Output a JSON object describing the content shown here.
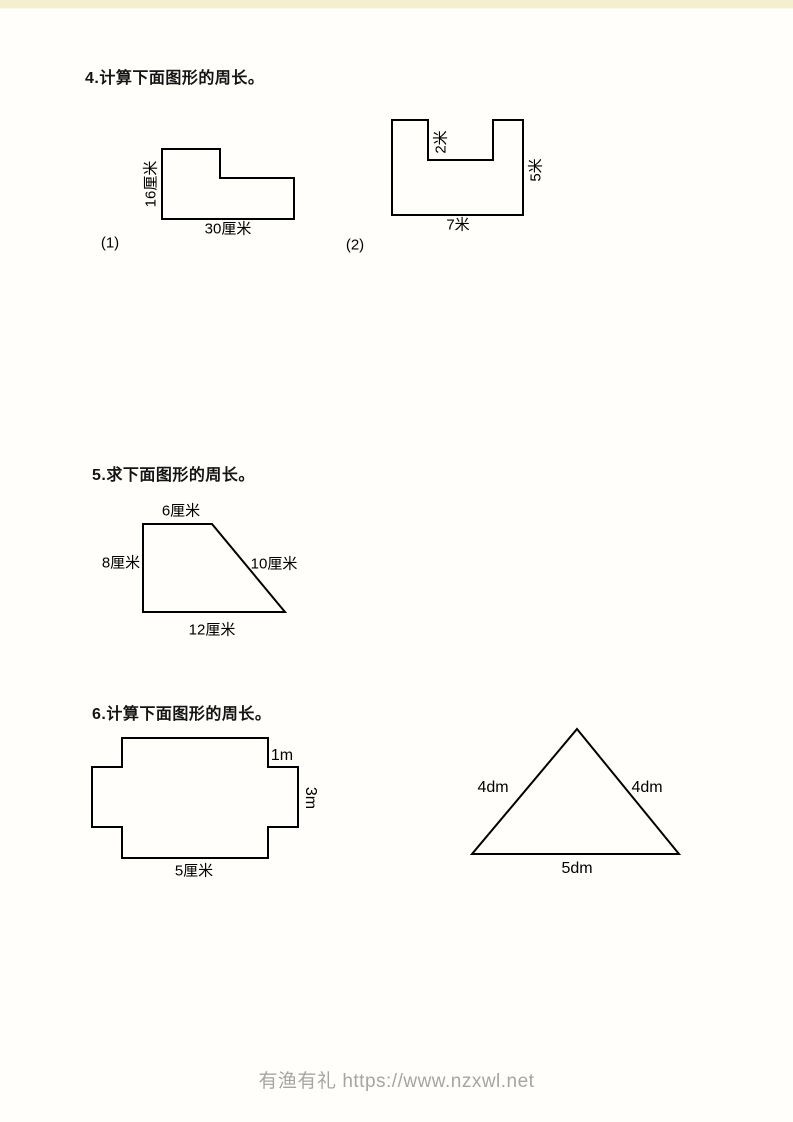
{
  "page": {
    "top_strip_color": "#f3efcf",
    "background": "#fffefa"
  },
  "problems": {
    "p4": {
      "title": "4.计算下面图形的周长。",
      "fig1": {
        "index": "(1)",
        "left": "16厘米",
        "bottom": "30厘米"
      },
      "fig2": {
        "index": "(2)",
        "notch": "2米",
        "right": "5米",
        "bottom": "7米"
      }
    },
    "p5": {
      "title": "5.求下面图形的周长。",
      "fig": {
        "top": "6厘米",
        "left": "8厘米",
        "slant": "10厘米",
        "bottom": "12厘米"
      }
    },
    "p6": {
      "title": "6.计算下面图形的周长。",
      "cross": {
        "step": "1m",
        "right": "3m",
        "bottom": "5厘米"
      },
      "triangle": {
        "left": "4dm",
        "right": "4dm",
        "bottom": "5dm"
      }
    }
  },
  "footer": {
    "text": "有渔有礼 https://www.nzxwl.net"
  }
}
